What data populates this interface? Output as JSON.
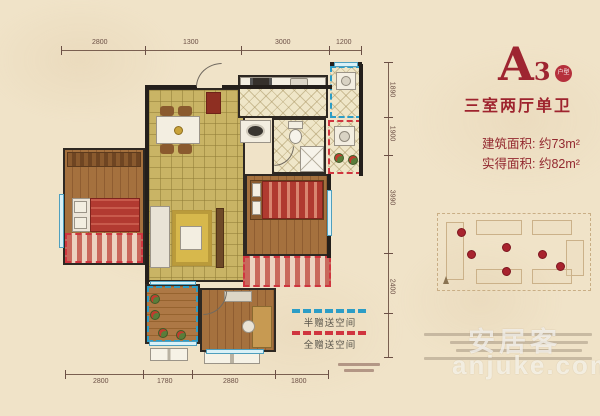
{
  "page": {
    "background": "#f0e3c8",
    "frame_color": "#b12a3a",
    "accent": "#9e2531"
  },
  "title": {
    "letter": "A",
    "number": "3",
    "badge": "户型",
    "subtitle": "三室两厅单卫"
  },
  "areas": {
    "built": "建筑面积: 约73m²",
    "actual": "实得面积: 约82m²"
  },
  "legend": {
    "items": [
      {
        "label": "半赠送空间",
        "color": "#2c9dc6"
      },
      {
        "label": "全赠送空间",
        "color": "#d0353f"
      }
    ]
  },
  "dimensions": {
    "top": [
      "2800",
      "1300",
      "3000",
      "1200"
    ],
    "bottom": [
      "2800",
      "1780",
      "2880",
      "1800"
    ],
    "right": [
      "1890",
      "1900",
      "3990",
      "2400"
    ]
  },
  "watermark": {
    "brand": "安居客",
    "domain": "anjuke.com"
  },
  "keyplan": {
    "unit_marker_color": "#a8232e"
  }
}
